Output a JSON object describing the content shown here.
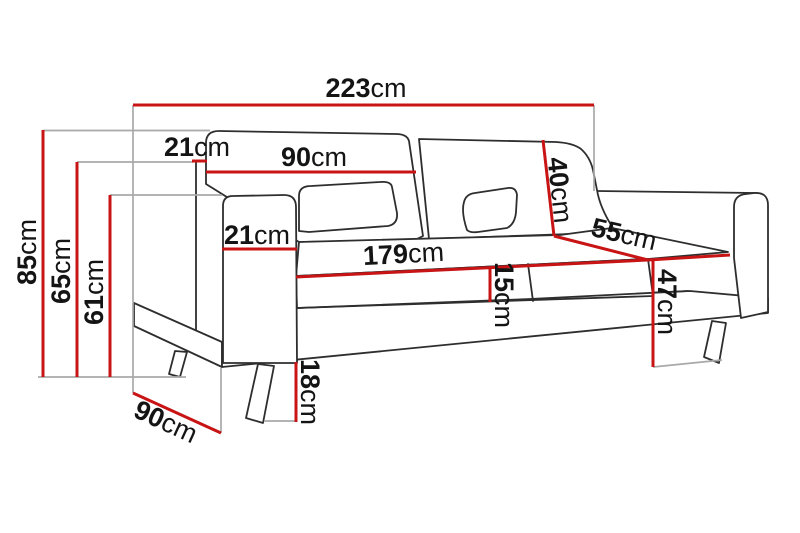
{
  "figure": {
    "title": "Sofa dimensions diagram",
    "unit": "cm",
    "accent_color": "#c81414",
    "extension_line_color": "#a9a9a9",
    "sketch_color": "#2e2e2e"
  },
  "dimensions": {
    "overall_width": {
      "value": "223",
      "unit": "cm"
    },
    "total_height": {
      "value": "85",
      "unit": "cm"
    },
    "back_frame_height": {
      "value": "65",
      "unit": "cm"
    },
    "armrest_height": {
      "value": "61",
      "unit": "cm"
    },
    "backrest_top_depth": {
      "value": "21",
      "unit": "cm"
    },
    "back_cushion_width": {
      "value": "90",
      "unit": "cm"
    },
    "back_cushion_height": {
      "value": "40",
      "unit": "cm"
    },
    "armrest_width": {
      "value": "21",
      "unit": "cm"
    },
    "seat_width": {
      "value": "179",
      "unit": "cm"
    },
    "seat_cushion_thickness": {
      "value": "15",
      "unit": "cm"
    },
    "seat_depth": {
      "value": "55",
      "unit": "cm"
    },
    "seat_height": {
      "value": "47",
      "unit": "cm"
    },
    "leg_height": {
      "value": "18",
      "unit": "cm"
    },
    "overall_depth": {
      "value": "90",
      "unit": "cm"
    }
  }
}
